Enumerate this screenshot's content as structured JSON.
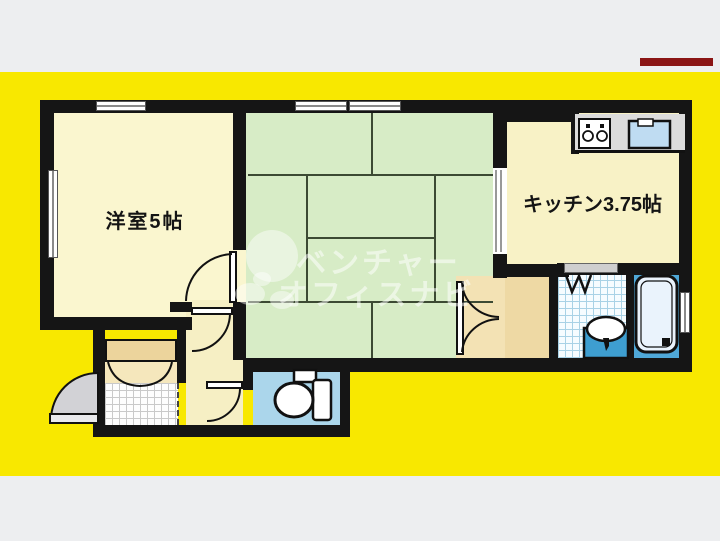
{
  "floorplan": {
    "rooms": {
      "western_room": {
        "label": "洋室5帖"
      },
      "kitchen": {
        "label": "キッチン3.75帖"
      },
      "tatami_room": {
        "label": ""
      }
    },
    "watermark": {
      "line1": "ベンチャー",
      "line2": "オフィスナビ"
    },
    "colors": {
      "canvas_yellow": "#F8E800",
      "page_gray": "#EDEEF0",
      "wall_black": "#151515",
      "room_cream": "#FAF6CF",
      "tatami_green": "#D7ECC6",
      "closet_tan": "#EED9A4",
      "toilet_floor_blue": "#ABD6EB",
      "bath_floor_blue": "#4FA8D8",
      "sink_blue": "#BFDCF2",
      "entrance_door_gray": "#D2D2D6",
      "artifact_red": "#8B1515"
    }
  }
}
